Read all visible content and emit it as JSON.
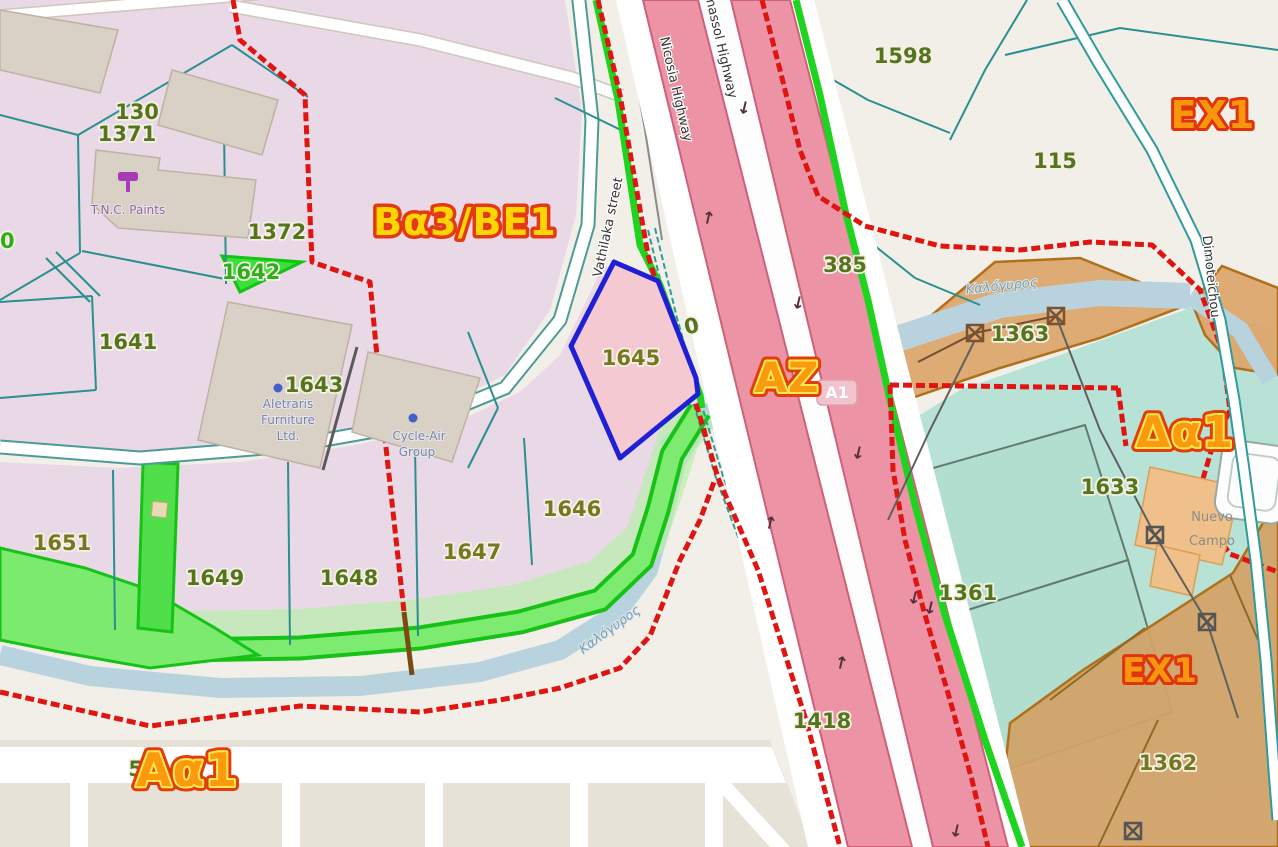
{
  "colors": {
    "zone_boundary_red": "#de1510",
    "selected_parcel_blue": "#1f1fd6",
    "protected_green": "#1ed41e",
    "motorway_pink": "#ec94a5",
    "water_blue": "#b9d3de",
    "lavender_zone": "#e9d9e7",
    "orange_zone": "#d9a05c",
    "mint_sports": "#b9e2d6",
    "zone_label_yellow": "#ffd504",
    "zone_label_orange": "#f8960e",
    "parcel_label_green": "#55751d"
  },
  "zone_labels": {
    "ba3be1": "Bα3/BE1",
    "ex1_top": "EX1",
    "az": "AZ",
    "da1": "Δα1",
    "aa1": "Aα1",
    "ex1_bottom": "EX1"
  },
  "parcel_labels": {
    "p130": "130",
    "p1371": "1371",
    "p1372": "1372",
    "p1642": "1642",
    "p1641": "1641",
    "p1643": "1643",
    "p1645": "1645",
    "p1646": "1646",
    "p1647": "1647",
    "p1648": "1648",
    "p1649": "1649",
    "p1651": "1651",
    "p1598": "1598",
    "p115": "115",
    "p385": "385",
    "p1363": "1363",
    "p1633": "1633",
    "p1361": "1361",
    "p1418": "1418",
    "p1362": "1362",
    "p51": "51",
    "p0_left": "0",
    "p0_highway": "0"
  },
  "street_labels": {
    "vathilaka": "Vathilaka street",
    "nicosia": "Nicosia Highway",
    "limassol": "Limassol Highway",
    "dimoteichou": "Dimoteichou"
  },
  "highway_shield": "A1",
  "water_labels": {
    "river_top": "Καλόγυρος",
    "river_bottom": "Καλόγυρος"
  },
  "poi_labels": {
    "tnc_paints": "T.N.C. Paints",
    "aletraris_1": "Aletraris",
    "aletraris_2": "Furniture",
    "aletraris_3": "Ltd.",
    "cycleair_1": "Cycle-Air",
    "cycleair_2": "Group",
    "nuevo_1": "Nuevo",
    "nuevo_2": "Campo"
  }
}
